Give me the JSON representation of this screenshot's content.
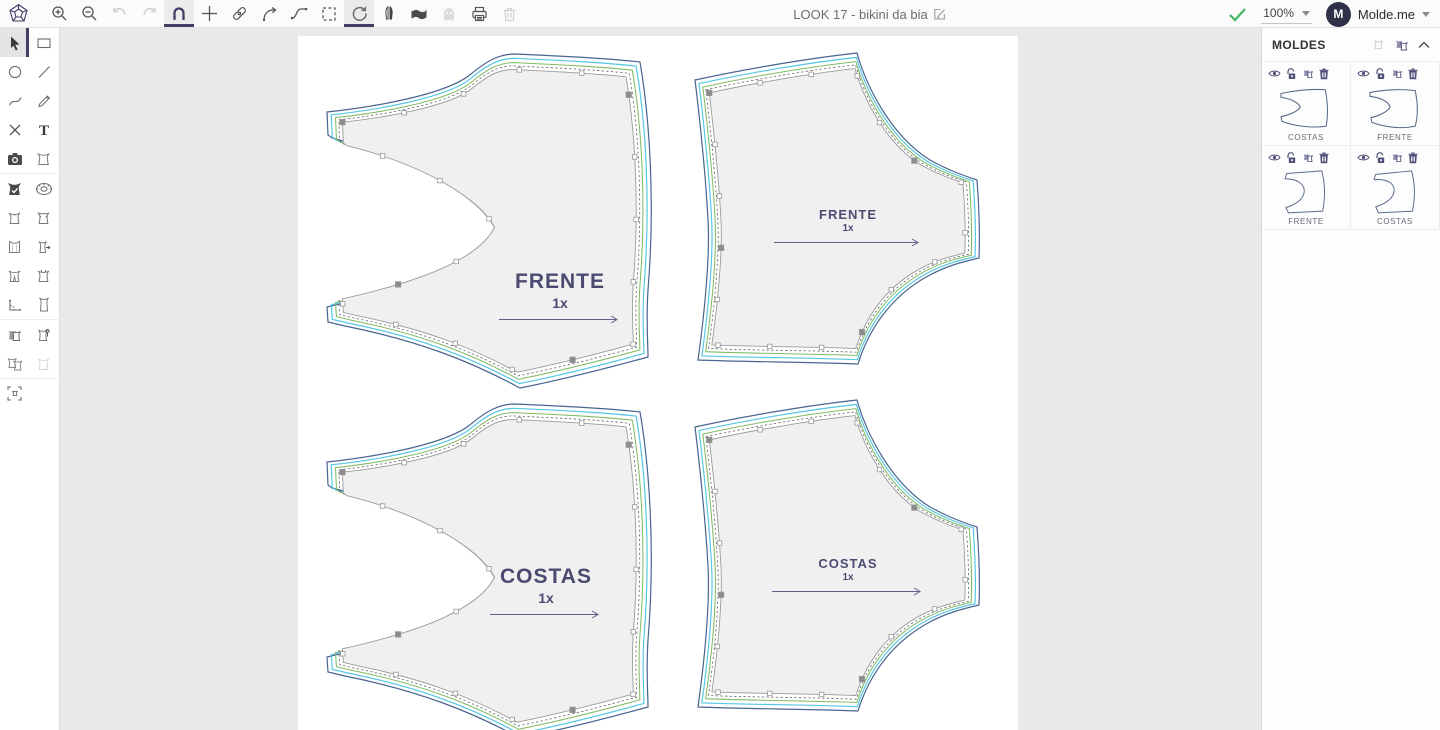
{
  "app": {
    "document_title": "LOOK 17 - bikini da bia",
    "zoom_level": "100%",
    "account_label": "Molde.me",
    "avatar_initial": "M"
  },
  "toolbar": {
    "tools": [
      {
        "name": "logo",
        "state": "normal"
      },
      {
        "name": "zoom-in",
        "state": "normal"
      },
      {
        "name": "zoom-out",
        "state": "normal"
      },
      {
        "name": "undo",
        "state": "disabled"
      },
      {
        "name": "redo",
        "state": "disabled"
      },
      {
        "name": "snap-magnet",
        "state": "active"
      },
      {
        "name": "crosshair",
        "state": "normal"
      },
      {
        "name": "blade",
        "state": "normal"
      },
      {
        "name": "curve-arrow",
        "state": "normal"
      },
      {
        "name": "spline",
        "state": "normal"
      },
      {
        "name": "marquee-select",
        "state": "normal"
      },
      {
        "name": "rotate",
        "state": "active"
      },
      {
        "name": "mirror",
        "state": "normal"
      },
      {
        "name": "fabric",
        "state": "normal"
      },
      {
        "name": "ghost",
        "state": "disabled"
      },
      {
        "name": "print",
        "state": "normal"
      },
      {
        "name": "delete",
        "state": "disabled"
      }
    ]
  },
  "sidebar": {
    "tools": [
      {
        "name": "select",
        "state": "selected"
      },
      {
        "name": "rectangle"
      },
      {
        "name": "ellipse"
      },
      {
        "name": "line"
      },
      {
        "name": "curve"
      },
      {
        "name": "pencil"
      },
      {
        "name": "delete-point"
      },
      {
        "name": "text"
      },
      {
        "name": "photo"
      },
      {
        "name": "piece"
      },
      {
        "name": "piece-check"
      },
      {
        "name": "measure-tape"
      },
      {
        "name": "piece-front"
      },
      {
        "name": "piece-back"
      },
      {
        "name": "piece-lines"
      },
      {
        "name": "piece-move"
      },
      {
        "name": "piece-dart"
      },
      {
        "name": "piece-notch"
      },
      {
        "name": "angle-measure"
      },
      {
        "name": "piece-tall"
      },
      {
        "name": "pieces-stack"
      },
      {
        "name": "piece-pin"
      },
      {
        "name": "pieces-copy"
      },
      {
        "name": "piece-disabled"
      },
      {
        "name": "center-piece"
      }
    ]
  },
  "panel": {
    "title": "MOLDES",
    "cards": [
      {
        "label": "COSTAS"
      },
      {
        "label": "FRENTE"
      },
      {
        "label": "FRENTE"
      },
      {
        "label": "COSTAS"
      }
    ]
  },
  "canvas": {
    "pieces": [
      {
        "label": "FRENTE",
        "quantity": "1x"
      },
      {
        "label": "FRENTE",
        "quantity": "1x"
      },
      {
        "label": "COSTAS",
        "quantity": "1x"
      },
      {
        "label": "COSTAS",
        "quantity": "1x"
      }
    ]
  },
  "colors": {
    "outline_navy": "#49648f",
    "outline_cyan": "#55c6e4",
    "outline_green": "#82ba65",
    "outline_gray": "#9b9b9b",
    "piece_fill": "#f0f0f0",
    "label_text": "#4b4b72",
    "accent": "#3f3f63",
    "success_check": "#43b566",
    "panel_icon": "#4e4e78"
  }
}
